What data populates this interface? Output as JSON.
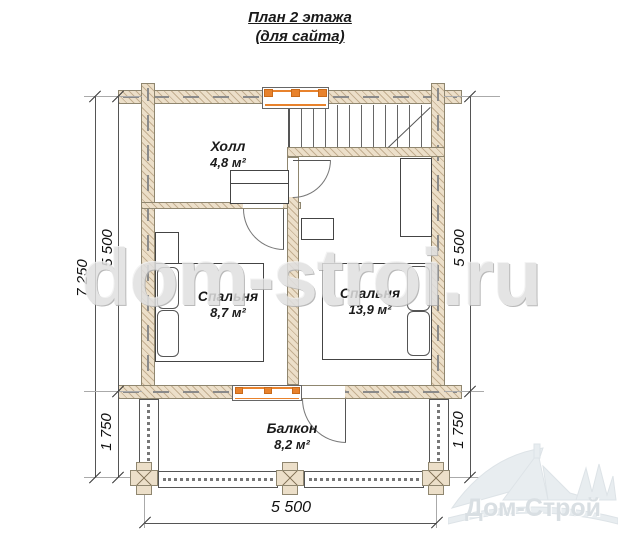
{
  "title": {
    "line1": "План 2 этажа",
    "line2": "(для сайта)"
  },
  "watermark": "dom-stroi.ru",
  "logo": {
    "name": "Дом-Строй"
  },
  "rooms": {
    "hall": {
      "name": "Холл",
      "area": "4,8 м²"
    },
    "bedroom_small": {
      "name": "Спальня",
      "area": "8,7 м²"
    },
    "bedroom_large": {
      "name": "Спальня",
      "area": "13,9 м²"
    },
    "balcony": {
      "name": "Балкон",
      "area": "8,2 м²"
    }
  },
  "dimensions": {
    "left_total": "7 250",
    "left_rooms": "5 500",
    "left_balcony": "1 750",
    "right_rooms": "5 500",
    "right_balcony": "1 750",
    "bottom_width": "5 500"
  },
  "colors": {
    "wall_fill": "#ecdfc9",
    "window_accent": "#e8822c",
    "line": "#555555"
  }
}
